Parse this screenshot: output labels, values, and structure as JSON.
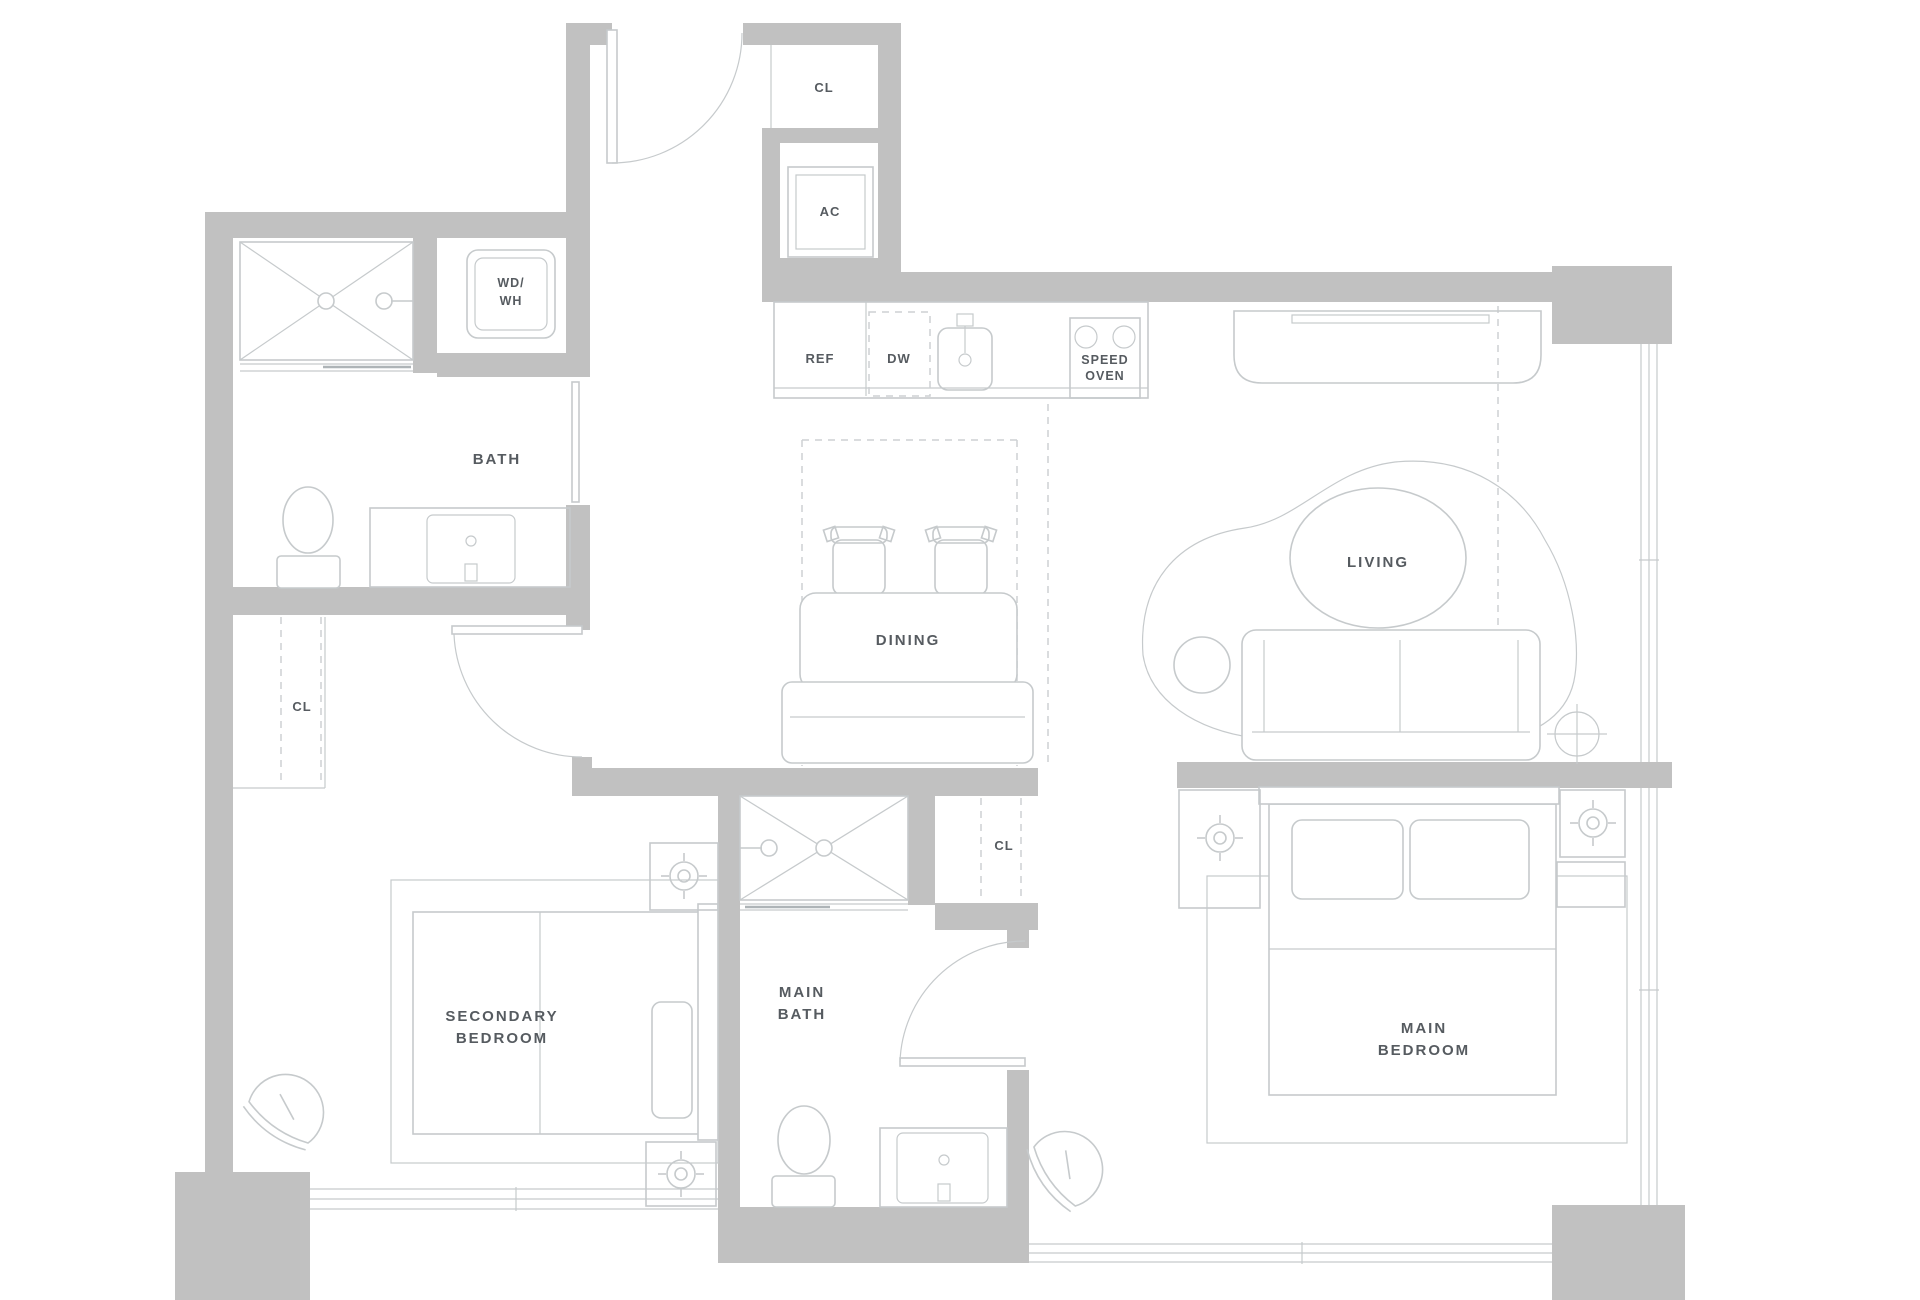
{
  "document": {
    "type": "apartment-floor-plan",
    "background": "#ffffff"
  },
  "colors": {
    "wall": "#c1c1c1",
    "furniture_line": "#c6cacc",
    "dashed_line": "#cdd1d3",
    "label_text": "#565b60"
  },
  "labels": {
    "closet_entry": "CL",
    "ac": "AC",
    "washer_line1": "WD/",
    "washer_line2": "WH",
    "fridge": "REF",
    "dishwasher": "DW",
    "oven_line1": "SPEED",
    "oven_line2": "OVEN",
    "bath": "BATH",
    "closet_hall": "CL",
    "dining": "DINING",
    "living": "LIVING",
    "secondary_bedroom_line1": "SECONDARY",
    "secondary_bedroom_line2": "BEDROOM",
    "main_bath_line1": "MAIN",
    "main_bath_line2": "BATH",
    "closet_main": "CL",
    "main_bedroom_line1": "MAIN",
    "main_bedroom_line2": "BEDROOM"
  }
}
